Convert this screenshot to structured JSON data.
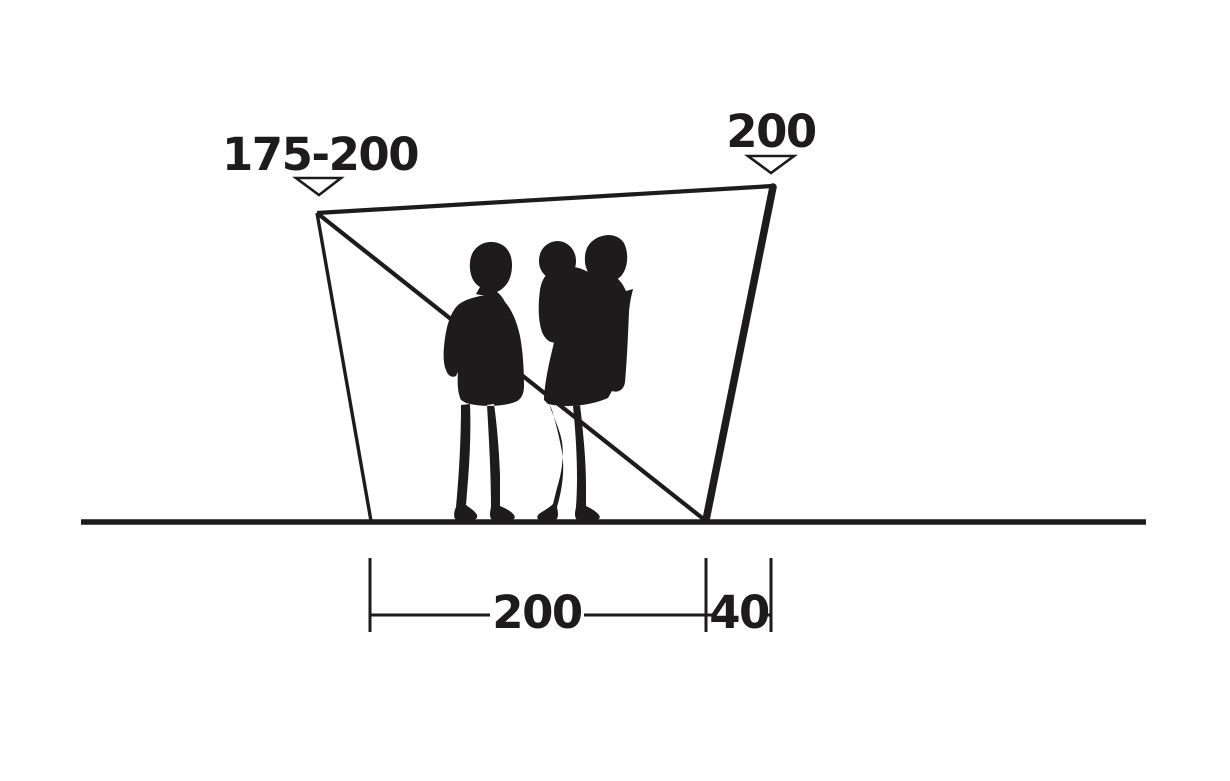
{
  "diagram": {
    "description": "Side-profile dimension drawing of a tent canopy / windbreak with family silhouette",
    "background_color": "#ffffff",
    "ink_color": "#1d1b1c",
    "dimensions": [
      {
        "id": "front-height",
        "label": "175-200",
        "marker": "triangle-down",
        "position": "top-left"
      },
      {
        "id": "rear-pole-height",
        "label": "200",
        "marker": "triangle-down",
        "position": "top-right"
      },
      {
        "id": "base-depth",
        "label": "200",
        "marker": "end-ticks",
        "position": "bottom-center"
      },
      {
        "id": "rear-offset",
        "label": "40",
        "marker": "end-ticks",
        "position": "bottom-right"
      }
    ],
    "figures": {
      "description": "black silhouette of two adults standing, one carrying a small child"
    }
  }
}
